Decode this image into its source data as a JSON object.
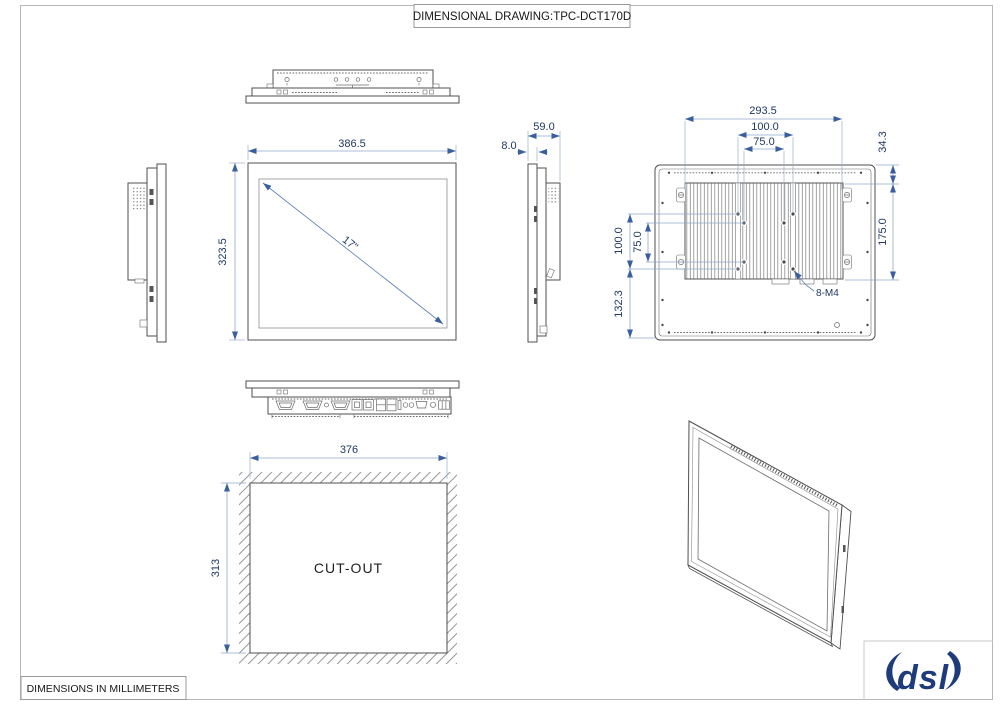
{
  "title_block": {
    "title": "DIMENSIONAL DRAWING:TPC-DCT170D"
  },
  "footer_block": {
    "note": "DIMENSIONS IN MILLIMETERS"
  },
  "logo": {
    "text": "dsl"
  },
  "front_view": {
    "width_label": "386.5",
    "height_label": "323.5",
    "diagonal_label": "17\""
  },
  "side_view": {
    "total_depth_label": "59.0",
    "panel_thickness_label": "8.0"
  },
  "rear_view": {
    "mount_width_label": "293.5",
    "vesa_width_100_label": "100.0",
    "vesa_width_75_label": "75.0",
    "top_offset_label": "34.3",
    "side_height_label": "175.0",
    "vesa_height_100_label": "100.0",
    "vesa_height_75_label": "75.0",
    "bottom_offset_label": "132.3",
    "mount_holes_label": "8-M4"
  },
  "cutout_view": {
    "width_label": "376",
    "height_label": "313",
    "area_label": "CUT-OUT"
  },
  "colors": {
    "dimension_text": "#1f3864",
    "dimension_line": "#8fa9cb",
    "arrow": "#3a5f9e",
    "drawing_line": "#4f4f4f",
    "logo_blue": "#1e3c7c"
  }
}
